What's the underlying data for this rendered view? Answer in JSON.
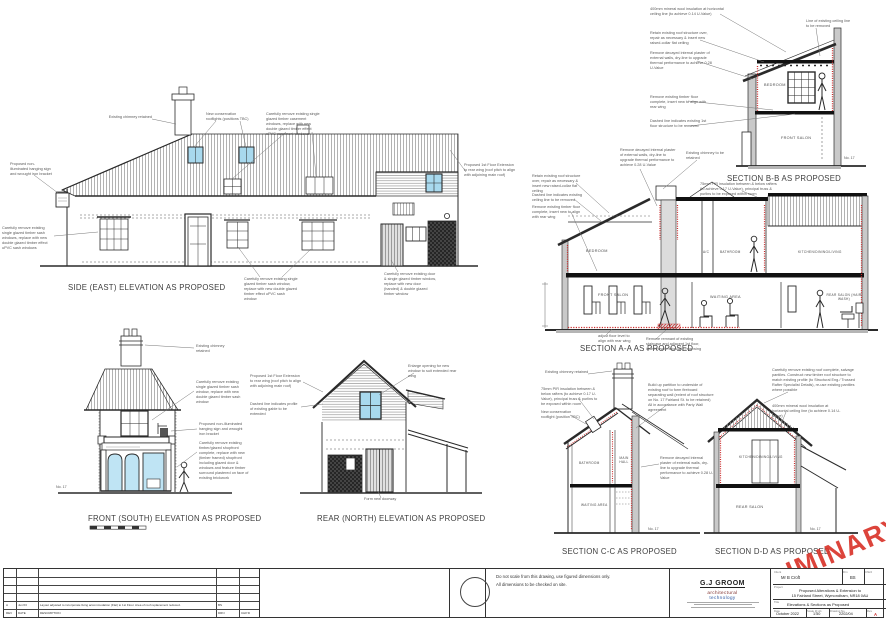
{
  "drawings": {
    "east": {
      "title": "SIDE (EAST) ELEVATION AS PROPOSED",
      "ann": {
        "chimney": "Existing chimney retained",
        "rooflights": "New conservation rooflights (positions TBC)",
        "casement": "Carefully remove existing single glazed timber casement windows, replace with new double glazed timber effect uPVC casement windows",
        "sign": "Proposed non-illuminated hanging sign and wrought iron bracket",
        "sash_left": "Carefully remove existing single glazed timber sash windows, replace with new double glazed timber effect uPVC sash windows",
        "sash_mid": "Carefully remove existing single glazed timber sash window, replace with new double glazed timber effect uPVC sash window",
        "extension": "Proposed 1st Floor Extension to rear wing (roof pitch to align with adjoining main roof)",
        "door": "Carefully remove existing door & single glazed timber window, replace with new door (handed) & double glazed timber window"
      }
    },
    "front": {
      "title": "FRONT (SOUTH) ELEVATION AS PROPOSED",
      "neighbour": "No. 17",
      "ann": {
        "chimney": "Existing chimney retained",
        "sash": "Carefully remove existing single glazed timber sash window, replace with new double glazed timber sash window",
        "sign": "Proposed non-illuminated hanging sign and wrought iron bracket",
        "shopfront": "Carefully remove existing timber/glazed shopfront complete, replace with new (timber framed) shopfront including glazed door & windows and feature timber surround plastered on face of existing brickwork"
      }
    },
    "rear": {
      "title": "REAR (NORTH) ELEVATION AS PROPOSED",
      "ann": {
        "extension": "Proposed 1st Floor Extension to rear wing (roof pitch to align with adjoining main roof)",
        "gable": "Dashed line indicates profile of existing gable to be extended",
        "window": "Enlarge opening for new window to suit extended rear wing",
        "doorway": "Form new doorway"
      }
    },
    "section_bb": {
      "title": "SECTION B-B AS PROPOSED",
      "neighbour": "No. 17",
      "rooms": {
        "bedroom": "BEDROOM",
        "front_salon": "FRONT SALON"
      },
      "ann": {
        "insulation": "400mm mineral wool insulation at horizontal ceiling line (to achieve 0.14 U-Value)",
        "ceiling_line": "Line of existing ceiling line to be removed",
        "roof": "Retain existing roof structure over, repair as necessary & insert new raised-collar flat ceiling",
        "plaster": "Remove decayed internal plaster of external walls, dry-line to upgrade thermal performance to achieve 0.28 U-Value",
        "floor": "Remove existing timber floor complete, insert new to align with rear wing",
        "dashed": "Dashed line indicates existing 1st floor structure to be removed"
      }
    },
    "section_aa": {
      "title": "SECTION A-A AS PROPOSED",
      "rooms": {
        "bedroom": "BEDROOM",
        "ac": "A/C",
        "bathroom": "BATHROOM",
        "kitchen": "KITCHEN/DINING/LIVING",
        "front_salon": "FRONT SALON",
        "waiting": "WAITING AREA",
        "rear_salon": "REAR SALON (HAIR WASH)"
      },
      "ann": {
        "roof": "Retain existing roof structure over, repair as necessary & insert new raised-collar flat ceiling",
        "dashed_ceiling": "Dashed line indicates existing ceiling line to be removed",
        "floor": "Remove existing timber floor complete, insert new to align with rear wing",
        "plaster": "Remove decayed internal plaster of external walls, dry-line to upgrade thermal performance to achieve 0.28 U-Value",
        "chimney": "Existing chimney to be retained",
        "pir": "75mm PIR insulation between & below rafters (to achieve 0.17 U-Value), principal truss & purlins to be exposed within room",
        "floor_level": "adjust floor level to align with rear wing",
        "stair": "Remove remnant of existing staircase and adjacent 1st floor, insert new to align with rear wing"
      }
    },
    "section_cc": {
      "title": "SECTION C-C AS PROPOSED",
      "neighbour": "No. 17",
      "rooms": {
        "bathroom": "BATHROOM",
        "hall": "MAIN HALL",
        "waiting": "WAITING AREA"
      },
      "ann": {
        "chimney": "Existing chimney retained",
        "pir": "75mm PIR insulation between & below rafters (to achieve 0.17 U-Value), principal truss & purlins to be exposed within room",
        "rooflight": "New conservation rooflight (position TBC)",
        "partition": "Build up partition to underside of existing roof to form fireboard separating wall (extent of roof structure on No. 17 Fairland St. to be retained) All in accordance with Party Wall agreement",
        "plaster": "Remove decayed internal plaster of external walls, dry-line to upgrade thermal performance to achieve 0.28 U-Value"
      }
    },
    "section_dd": {
      "title": "SECTION D-D AS PROPOSED",
      "neighbour": "No. 17",
      "rooms": {
        "kitchen": "KITCHEN/DINING/LIVING",
        "rear_salon": "REAR SALON"
      },
      "ann": {
        "roof": "Carefully remove existing roof complete, salvage pantiles. Construct new timber roof structure to match existing profile (to Structural Eng./ Trussed Rafter Specialist Details), re-use existing pantiles where possible",
        "insulation": "400mm mineral wool insulation at horizontal ceiling line (to achieve 0.14 U-Value)"
      }
    }
  },
  "watermark": {
    "text": "PRELIMINARY",
    "color": "#da352b"
  },
  "title_block": {
    "notes": [
      "Do not scale from this drawing, use figured dimensions only.",
      "All dimensions to be checked on site."
    ],
    "firm": {
      "name": "G.J GROOM",
      "line1": "architectural",
      "line2": "technology"
    },
    "fields": {
      "client_label": "Client",
      "client": "Mr B Croft",
      "drn_label": "Drn",
      "drn": "BS",
      "chkd_label": "Chk'd",
      "chkd": "",
      "project_label": "Project",
      "project_line1": "Proposed Alterations & Extension to",
      "project_line2": "15 Fairland Street, Wymondham, NR18 0AU",
      "title_label": "Title",
      "title": "Elevations & Sections as Proposed",
      "date_label": "Date",
      "date": "October 2022",
      "scale_label": "Scale @ A1",
      "scale": "1:50",
      "number_label": "Drawing No.",
      "number": "2202/04",
      "rev_label": "Rev",
      "rev": "A"
    }
  },
  "revision_table": {
    "headers": [
      "REV",
      "DATE",
      "DESCRIPTION",
      "DRN",
      "CHK'D"
    ],
    "row": {
      "rev": "A",
      "date": "Jun'23",
      "description": "Layout adjusted to incorporate living accommodation (Flat) to 1st Floor. Area of roof replacement reduced.",
      "drn": "BS",
      "chkd": ""
    }
  },
  "colors": {
    "accent_red": "#cc2a2a",
    "window_blue": "#a8d9ee",
    "wall_gray": "#c9c9c9"
  }
}
